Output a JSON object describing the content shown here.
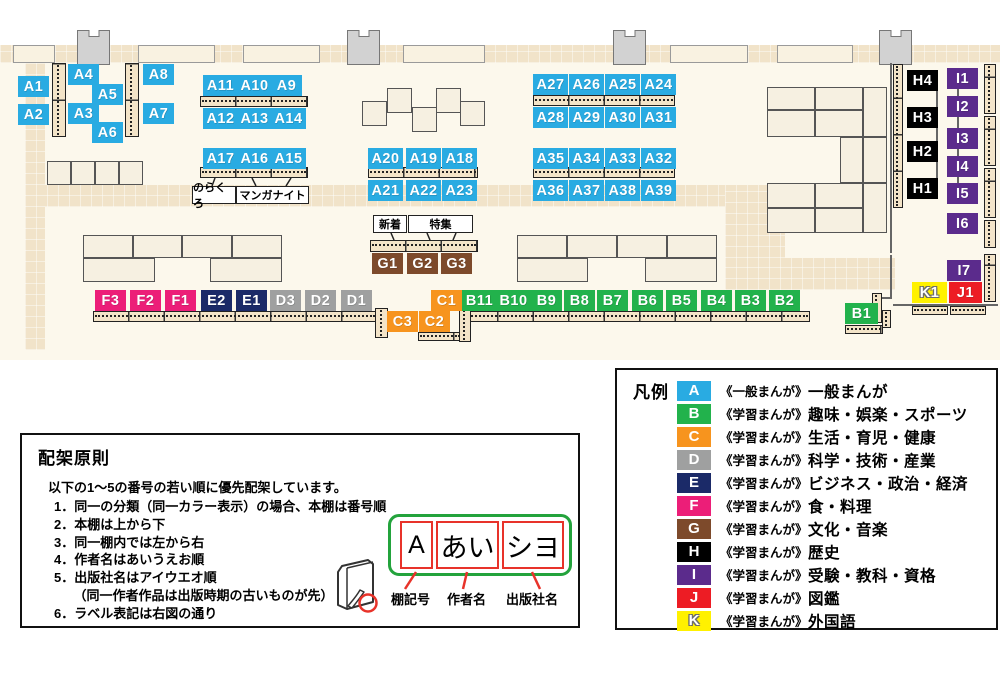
{
  "colors": {
    "A": "#29ABE2",
    "B": "#22B24C",
    "C": "#F7941E",
    "D": "#9FA0A0",
    "E": "#1B2A68",
    "F": "#EC1E78",
    "G": "#7D4A2B",
    "H": "#000000",
    "I": "#5B2B8C",
    "J": "#ED1C24",
    "K": "#FFF100"
  },
  "map": {
    "tags": [
      {
        "id": "A1",
        "x": 18,
        "y": 76
      },
      {
        "id": "A2",
        "x": 18,
        "y": 104
      },
      {
        "id": "A4",
        "x": 68,
        "y": 64
      },
      {
        "id": "A5",
        "x": 92,
        "y": 84
      },
      {
        "id": "A3",
        "x": 68,
        "y": 103
      },
      {
        "id": "A6",
        "x": 92,
        "y": 122
      },
      {
        "id": "A8",
        "x": 143,
        "y": 64
      },
      {
        "id": "A7",
        "x": 143,
        "y": 103
      },
      {
        "id": "A11",
        "x": 203,
        "y": 75
      },
      {
        "id": "A10",
        "x": 237,
        "y": 75
      },
      {
        "id": "A9",
        "x": 271,
        "y": 75
      },
      {
        "id": "A12",
        "x": 203,
        "y": 108
      },
      {
        "id": "A13",
        "x": 237,
        "y": 108
      },
      {
        "id": "A14",
        "x": 271,
        "y": 108
      },
      {
        "id": "A17",
        "x": 203,
        "y": 148
      },
      {
        "id": "A16",
        "x": 237,
        "y": 148
      },
      {
        "id": "A15",
        "x": 271,
        "y": 148
      },
      {
        "id": "A20",
        "x": 368,
        "y": 148
      },
      {
        "id": "A19",
        "x": 406,
        "y": 148
      },
      {
        "id": "A18",
        "x": 442,
        "y": 148
      },
      {
        "id": "A21",
        "x": 368,
        "y": 180
      },
      {
        "id": "A22",
        "x": 406,
        "y": 180
      },
      {
        "id": "A23",
        "x": 442,
        "y": 180
      },
      {
        "id": "A27",
        "x": 533,
        "y": 74
      },
      {
        "id": "A26",
        "x": 569,
        "y": 74
      },
      {
        "id": "A25",
        "x": 605,
        "y": 74
      },
      {
        "id": "A24",
        "x": 641,
        "y": 74
      },
      {
        "id": "A28",
        "x": 533,
        "y": 107
      },
      {
        "id": "A29",
        "x": 569,
        "y": 107
      },
      {
        "id": "A30",
        "x": 605,
        "y": 107
      },
      {
        "id": "A31",
        "x": 641,
        "y": 107
      },
      {
        "id": "A35",
        "x": 533,
        "y": 148
      },
      {
        "id": "A34",
        "x": 569,
        "y": 148
      },
      {
        "id": "A33",
        "x": 605,
        "y": 148
      },
      {
        "id": "A32",
        "x": 641,
        "y": 148
      },
      {
        "id": "A36",
        "x": 533,
        "y": 180
      },
      {
        "id": "A37",
        "x": 569,
        "y": 180
      },
      {
        "id": "A38",
        "x": 605,
        "y": 180
      },
      {
        "id": "A39",
        "x": 641,
        "y": 180
      },
      {
        "id": "G1",
        "x": 372,
        "y": 253
      },
      {
        "id": "G2",
        "x": 407,
        "y": 253
      },
      {
        "id": "G3",
        "x": 441,
        "y": 253
      },
      {
        "id": "F3",
        "x": 95,
        "y": 290
      },
      {
        "id": "F2",
        "x": 130,
        "y": 290
      },
      {
        "id": "F1",
        "x": 165,
        "y": 290
      },
      {
        "id": "E2",
        "x": 201,
        "y": 290
      },
      {
        "id": "E1",
        "x": 236,
        "y": 290
      },
      {
        "id": "D3",
        "x": 270,
        "y": 290
      },
      {
        "id": "D2",
        "x": 305,
        "y": 290
      },
      {
        "id": "D1",
        "x": 341,
        "y": 290
      },
      {
        "id": "C1",
        "x": 431,
        "y": 290
      },
      {
        "id": "C3",
        "x": 387,
        "y": 311
      },
      {
        "id": "C2",
        "x": 419,
        "y": 311
      },
      {
        "id": "B11",
        "x": 462,
        "y": 290
      },
      {
        "id": "B10",
        "x": 496,
        "y": 290
      },
      {
        "id": "B9",
        "x": 531,
        "y": 290
      },
      {
        "id": "B8",
        "x": 564,
        "y": 290
      },
      {
        "id": "B7",
        "x": 597,
        "y": 290
      },
      {
        "id": "B6",
        "x": 632,
        "y": 290
      },
      {
        "id": "B5",
        "x": 666,
        "y": 290
      },
      {
        "id": "B4",
        "x": 701,
        "y": 290
      },
      {
        "id": "B3",
        "x": 735,
        "y": 290
      },
      {
        "id": "B2",
        "x": 769,
        "y": 290
      },
      {
        "id": "B1",
        "x": 845,
        "y": 303,
        "w": 33
      },
      {
        "id": "H4",
        "x": 907,
        "y": 70
      },
      {
        "id": "H3",
        "x": 907,
        "y": 107
      },
      {
        "id": "H2",
        "x": 907,
        "y": 141
      },
      {
        "id": "H1",
        "x": 907,
        "y": 178
      },
      {
        "id": "I1",
        "x": 947,
        "y": 68
      },
      {
        "id": "I2",
        "x": 947,
        "y": 96
      },
      {
        "id": "I3",
        "x": 947,
        "y": 128
      },
      {
        "id": "I4",
        "x": 947,
        "y": 156
      },
      {
        "id": "I5",
        "x": 947,
        "y": 183
      },
      {
        "id": "I6",
        "x": 947,
        "y": 213
      },
      {
        "id": "I7",
        "x": 947,
        "y": 260,
        "w": 34
      },
      {
        "id": "K1",
        "x": 912,
        "y": 282,
        "w": 35
      },
      {
        "id": "J1",
        "x": 949,
        "y": 282,
        "w": 33
      }
    ],
    "callouts": [
      {
        "id": "shinchaku",
        "text": "新着",
        "x": 373,
        "y": 215,
        "w": 34
      },
      {
        "id": "tokushu",
        "text": "特集",
        "x": 408,
        "y": 215,
        "w": 65
      },
      {
        "id": "norakuro",
        "text": "のらくろ",
        "x": 192,
        "y": 186,
        "w": 44
      },
      {
        "id": "manga-night",
        "text": "マンガナイト",
        "x": 236,
        "y": 186,
        "w": 73
      }
    ]
  },
  "legend": {
    "title": "凡例",
    "rows": [
      {
        "letter": "A",
        "type": "《一般まんが》",
        "label": "一般まんが"
      },
      {
        "letter": "B",
        "type": "《学習まんが》",
        "label": "趣味・娯楽・スポーツ"
      },
      {
        "letter": "C",
        "type": "《学習まんが》",
        "label": "生活・育児・健康"
      },
      {
        "letter": "D",
        "type": "《学習まんが》",
        "label": "科学・技術・産業"
      },
      {
        "letter": "E",
        "type": "《学習まんが》",
        "label": "ビジネス・政治・経済"
      },
      {
        "letter": "F",
        "type": "《学習まんが》",
        "label": "食・料理"
      },
      {
        "letter": "G",
        "type": "《学習まんが》",
        "label": "文化・音楽"
      },
      {
        "letter": "H",
        "type": "《学習まんが》",
        "label": "歴史"
      },
      {
        "letter": "I",
        "type": "《学習まんが》",
        "label": "受験・教科・資格"
      },
      {
        "letter": "J",
        "type": "《学習まんが》",
        "label": "図鑑"
      },
      {
        "letter": "K",
        "type": "《学習まんが》",
        "label": "外国語"
      }
    ]
  },
  "principles": {
    "title": "配架原則",
    "intro": "以下の1～5の番号の若い順に優先配架しています。",
    "items": [
      "1．同一の分類（同一カラー表示）の場合、本棚は番号順",
      "2．本棚は上から下",
      "3．同一棚内では左から右",
      "4．作者名はあいうえお順",
      "5．出版社名はアイウエオ順",
      "　　（同一作者作品は出版時期の古いものが先）",
      "6．ラベル表記は右図の通り"
    ]
  },
  "label_diagram": {
    "shelf_code": "A",
    "author": "あい",
    "publisher": "シヨ",
    "caption_shelf": "棚記号",
    "caption_author": "作者名",
    "caption_publisher": "出版社名"
  }
}
